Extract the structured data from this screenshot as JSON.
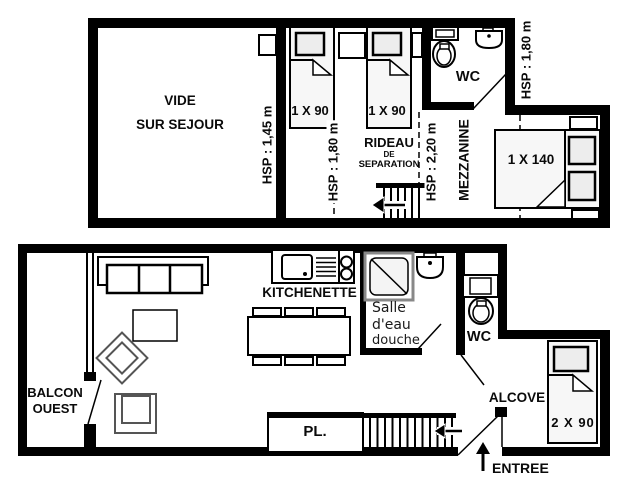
{
  "title": "Apartment floor plan (mezzanine level and main level)",
  "colors": {
    "wall": "#000000",
    "background": "#ffffff",
    "bed_fill": "#f7f7f7",
    "pillow_fill": "#ededed"
  },
  "upper_floor": {
    "vide_line1": "VIDE",
    "vide_line2": "SUR SEJOUR",
    "hsp_145": "HSP : 1,45 m",
    "bed1_label": "1 X 90",
    "bed2_label": "1 X 90",
    "hsp_180_mid": "HSP : 1,80 m",
    "rideau_line1": "RIDEAU",
    "rideau_line2": "DE",
    "rideau_line3": "SEPARATION",
    "hsp_220": "HSP : 2,20 m",
    "mezzanine_label": "MEZZANINE",
    "wc_label": "WC",
    "hsp_180_right": "HSP : 1,80 m",
    "bed140_label": "1 X 140"
  },
  "lower_floor": {
    "balcon_line1": "BALCON",
    "balcon_line2": "OUEST",
    "kitchenette_label": "KITCHENETTE",
    "salle_line1": "Salle",
    "salle_line2": "d'eau",
    "salle_line3": "douche",
    "wc_label": "WC",
    "alcove_label": "ALCOVE",
    "bed_label": "2 X 90",
    "pl_label": "PL.",
    "entree_label": "ENTREE"
  }
}
